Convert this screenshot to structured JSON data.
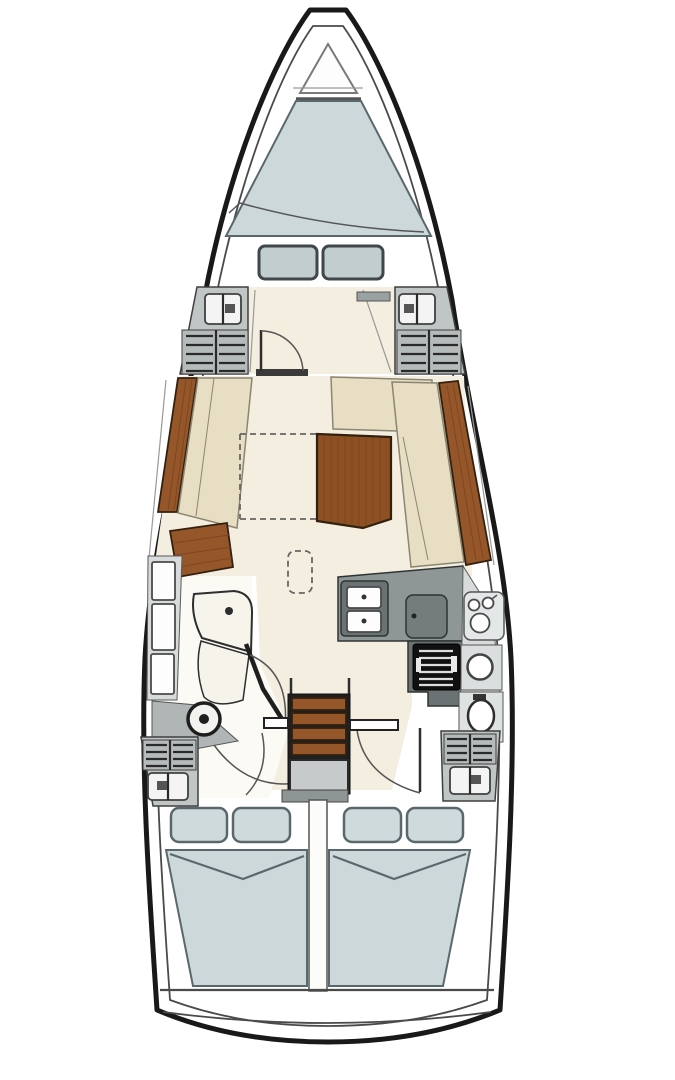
{
  "diagram": {
    "type": "sailing-yacht-interior-floorplan",
    "orientation": "bow-up",
    "description": "Sailing yacht interior layout plan, top view, bow up: anchor locker, forward V-berth cabin with foot cushions, wardrobe lockers, saloon with port sofa, starboard L-sofa and folding wood table, navigation station with stool to port, L-shaped galley with double sink, fridge and stove to starboard, head with vanity, washbasin and toilet, companionway steps over engine box, and twin aft double cabins"
  },
  "colors": {
    "hull_outline": "#191919",
    "deck_line": "#4a4a4a",
    "floor_cream": "#f3eedf",
    "floor_light": "#fbfaf5",
    "bed_blue": "#ccd8da",
    "pillow_blue": "#cfdadc",
    "hatch_cushion": "#c2cdcf",
    "cushion_outline": "#3f474b",
    "bed_outline": "#5a686d",
    "seat_beige": "#e7dec3",
    "seat_outline": "#8b8672",
    "wood": "#95572a",
    "wood_grain": "#7c431e",
    "wood_outline": "#33210f",
    "table_wood": "#8c5022",
    "counter_gray": "#8f9696",
    "unit_dark": "#6b7273",
    "fridge_gray": "#757c7c",
    "locker_gray": "#c0c5c6",
    "locker_slat_bg": "#b5babb",
    "panel_light": "#d7dbdb",
    "panel_lighter": "#e4e7e7",
    "fixture_white": "#fdfdfd",
    "stove_black": "#101010",
    "stove_stripe": "#dddddd",
    "line_dark": "#2e2e2e",
    "engine_gray": "#c6caca",
    "step_gray": "#8e9595",
    "tri_gray": "#b0b6b6",
    "sill_dark": "#3a3a3a"
  },
  "components": [
    {
      "name": "anchor-locker",
      "kind": "triangle outline at bow"
    },
    {
      "name": "v-berth-bed",
      "kind": "forward double berth, blue-gray"
    },
    {
      "name": "berth-foot-cushions",
      "kind": "two rounded cushions"
    },
    {
      "name": "wardrobe-lockers",
      "kind": "gray cabinets with louvered slats"
    },
    {
      "name": "forward-cabin-door",
      "kind": "door with swing arc"
    },
    {
      "name": "port-sofa",
      "kind": "straight bench seat"
    },
    {
      "name": "starboard-l-sofa",
      "kind": "L-shaped bench seat"
    },
    {
      "name": "saloon-table",
      "kind": "wood table with dashed folding extension"
    },
    {
      "name": "nav-station",
      "kind": "chart table, stool, wet locker"
    },
    {
      "name": "galley",
      "kind": "L-counter, double sink, fridge, gimbaled stove"
    },
    {
      "name": "head",
      "kind": "vanity with taps, washbasin, toilet"
    },
    {
      "name": "companionway",
      "kind": "four wood steps over engine box"
    },
    {
      "name": "aft-cabin-port",
      "kind": "double berth with two pillows"
    },
    {
      "name": "aft-cabin-starboard",
      "kind": "double berth with two pillows"
    }
  ]
}
